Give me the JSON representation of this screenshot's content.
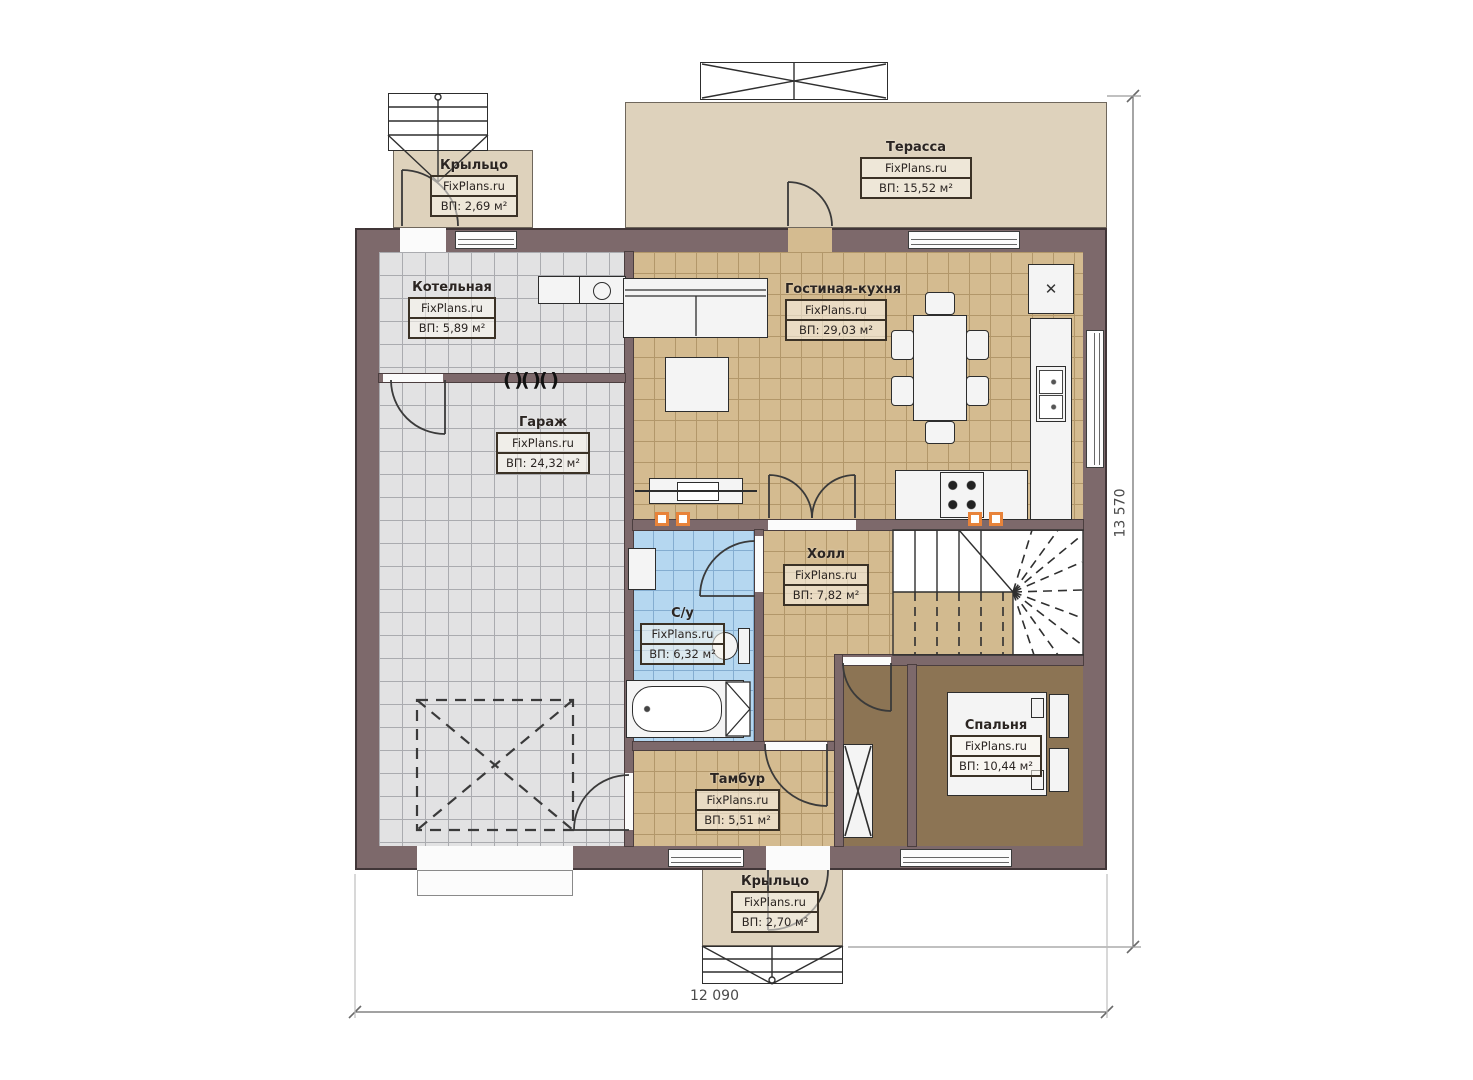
{
  "rooms": {
    "porch_top": {
      "name": "Крыльцо",
      "brand": "FixPlans.ru",
      "area": "ВП: 2,69 м²"
    },
    "terrace": {
      "name": "Терасса",
      "brand": "FixPlans.ru",
      "area": "ВП: 15,52 м²"
    },
    "boiler": {
      "name": "Котельная",
      "brand": "FixPlans.ru",
      "area": "ВП: 5,89 м²"
    },
    "living_kitchen": {
      "name": "Гостиная-кухня",
      "brand": "FixPlans.ru",
      "area": "ВП: 29,03 м²"
    },
    "garage": {
      "name": "Гараж",
      "brand": "FixPlans.ru",
      "area": "ВП: 24,32 м²"
    },
    "hall": {
      "name": "Холл",
      "brand": "FixPlans.ru",
      "area": "ВП: 7,82 м²"
    },
    "bathroom": {
      "name": "С/у",
      "brand": "FixPlans.ru",
      "area": "ВП: 6,32 м²"
    },
    "bedroom": {
      "name": "Спальня",
      "brand": "FixPlans.ru",
      "area": "ВП: 10,44 м²"
    },
    "vestibule": {
      "name": "Тамбур",
      "brand": "FixPlans.ru",
      "area": "ВП: 5,51 м²"
    },
    "porch_bottom": {
      "name": "Крыльцо",
      "brand": "FixPlans.ru",
      "area": "ВП: 2,70 м²"
    }
  },
  "dimensions": {
    "width": "12 090",
    "height": "13 570"
  },
  "icons": {
    "appliance_cross": "✕"
  },
  "colors": {
    "wall": "#7d696b",
    "floor_tile_tan": "#d4bb90",
    "floor_tile_gray": "#e2e2e3",
    "floor_tile_blue": "#b5d7f0",
    "floor_wood_brown": "#8c7454",
    "deck_beige": "#ded2bc",
    "vent_orange": "#e8833a"
  }
}
